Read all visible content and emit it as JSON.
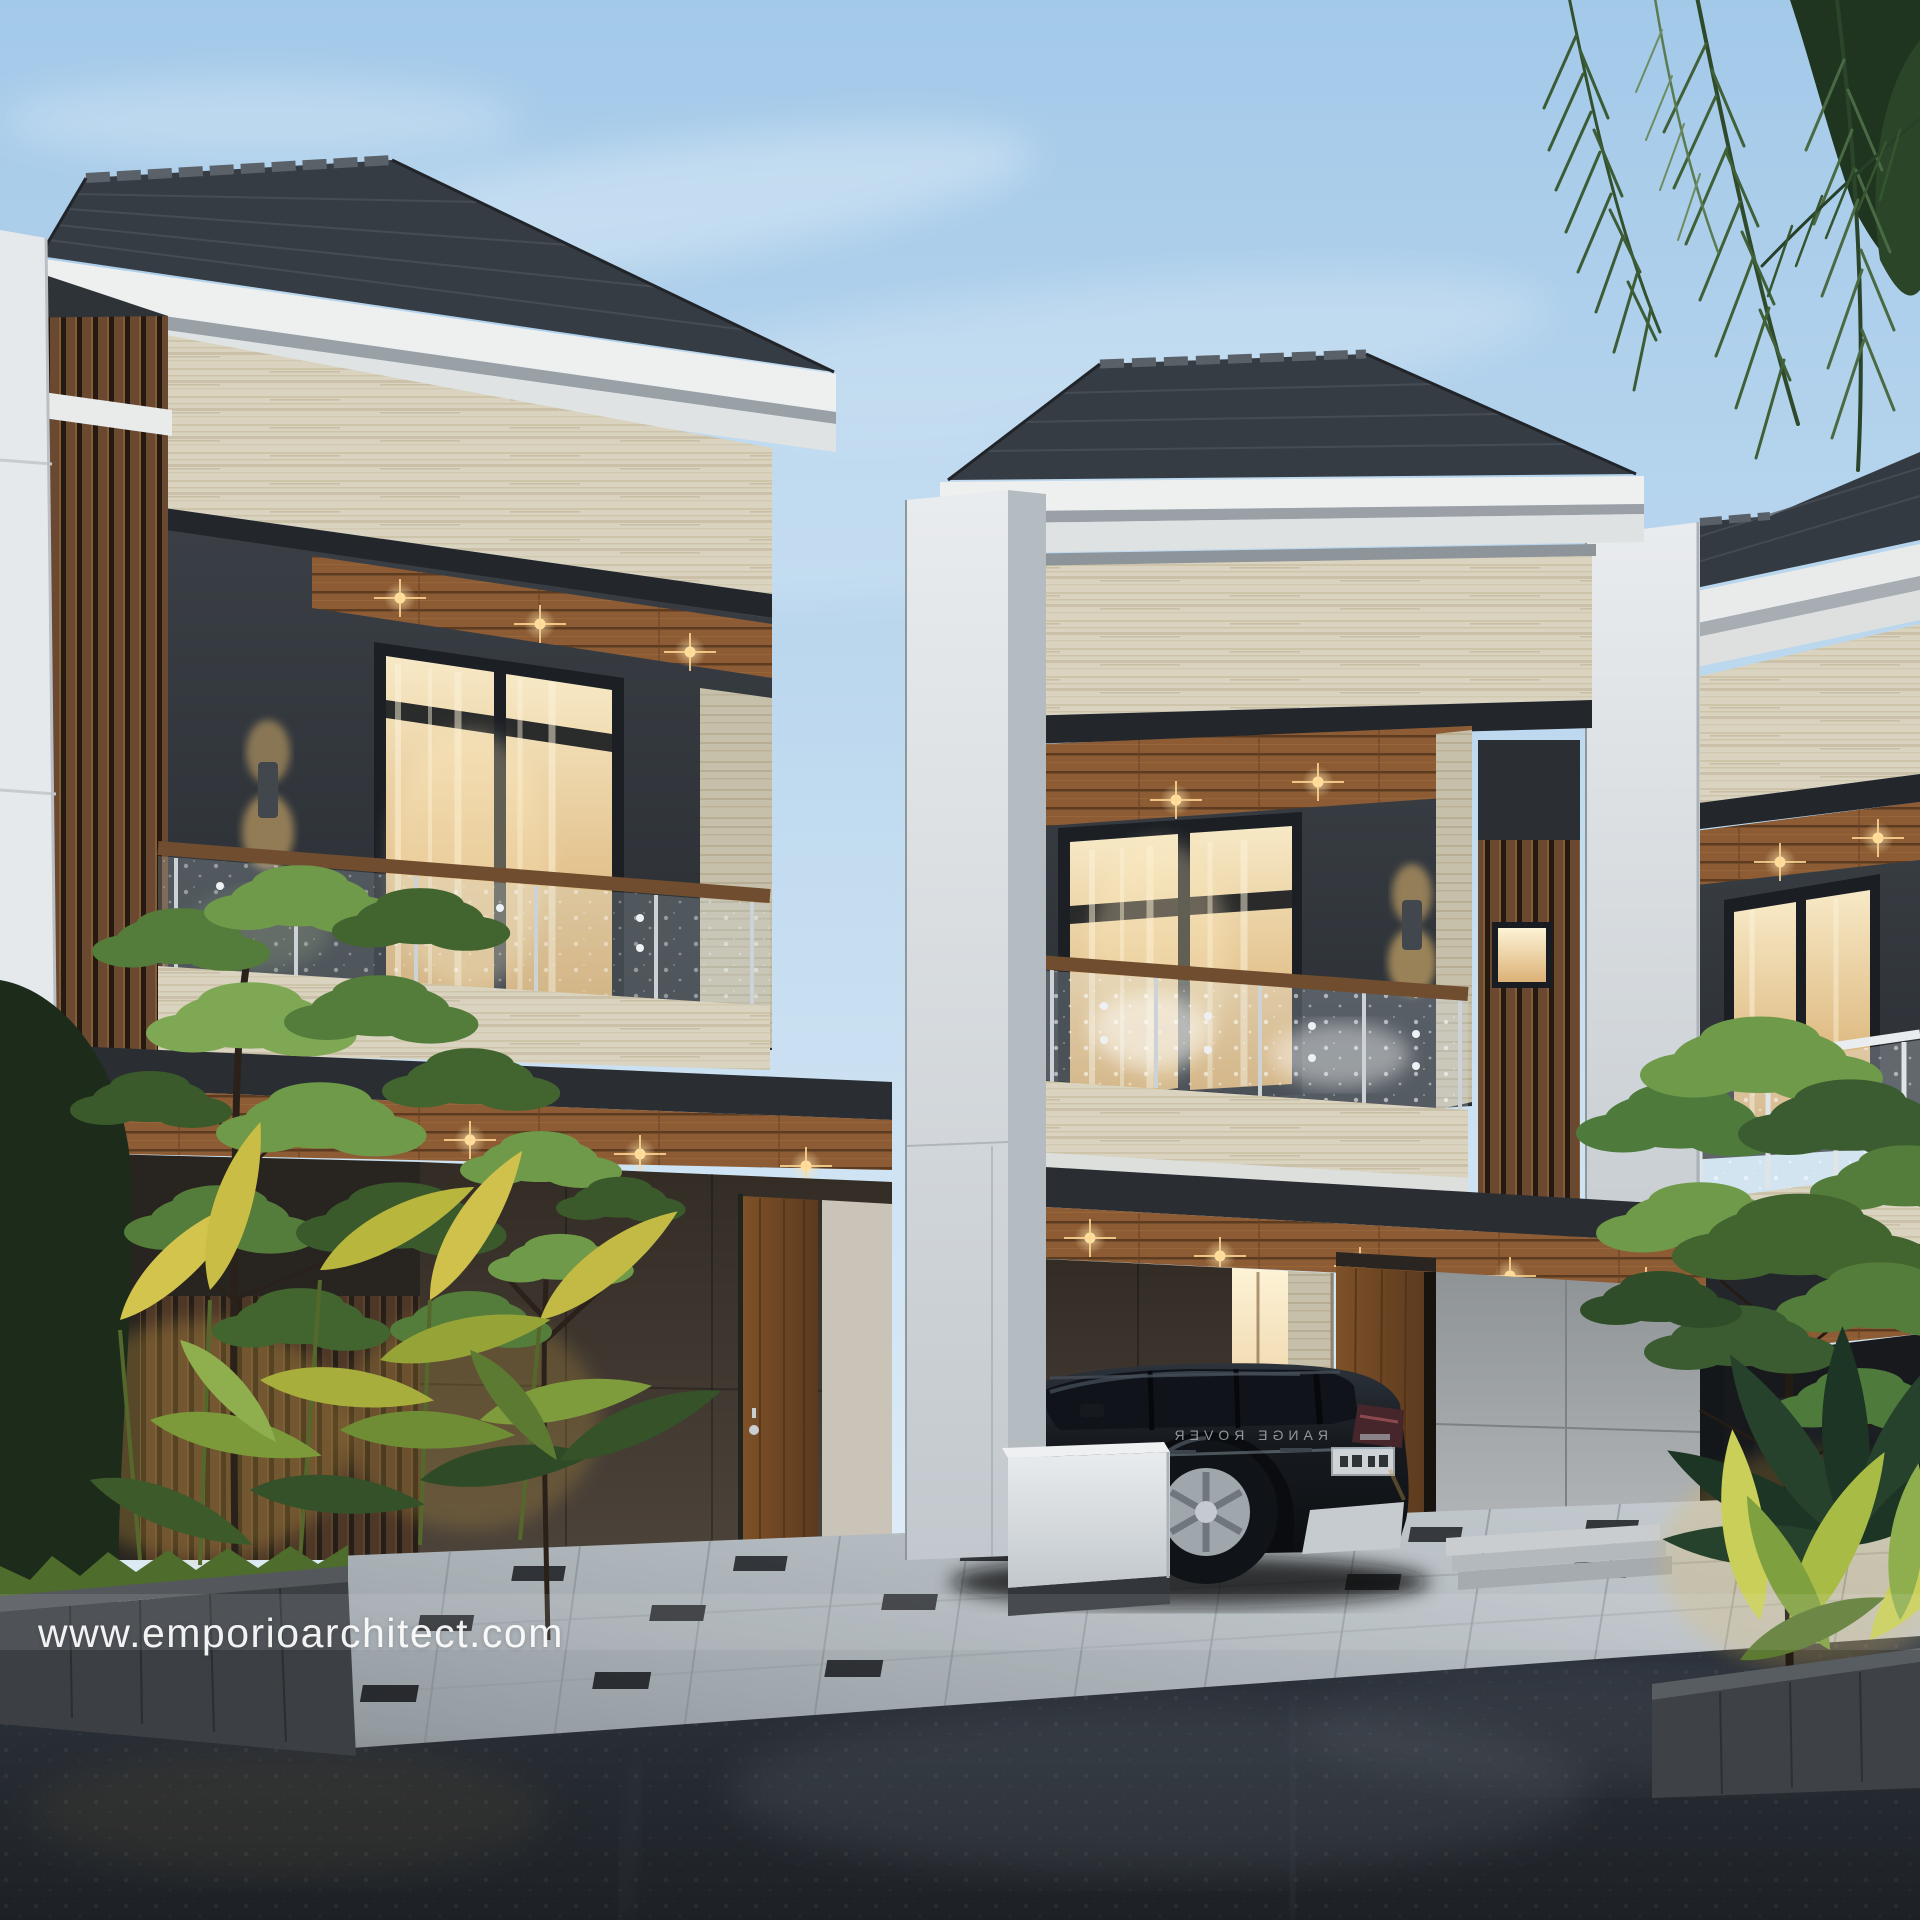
{
  "watermark": {
    "text": "www.emporioarchitect.com"
  },
  "vehicle": {
    "tailgate_badge": "RANGE ROVER",
    "type": "dark SUV parked in carport"
  },
  "scene": {
    "subject": "modern two-storey row houses at dusk",
    "units_visible": 3,
    "ground": "wet asphalt street and grey paver driveway"
  },
  "palette": {
    "sky_top": "#a3c9e9",
    "sky_horizon": "#dcebf6",
    "roof_tile": "#343a41",
    "fascia_white": "#eef0ef",
    "travertine": "#d9d3bf",
    "charcoal_wall": "#31353a",
    "wood_slats": "#6b4930",
    "wood_soffit": "#8d5c34",
    "warm_light": "#f6d89a",
    "paving_grey": "#aeb5ba",
    "asphalt": "#23282e",
    "foliage_lit": "#cfc14b",
    "foliage_dark": "#2c4a2e"
  }
}
